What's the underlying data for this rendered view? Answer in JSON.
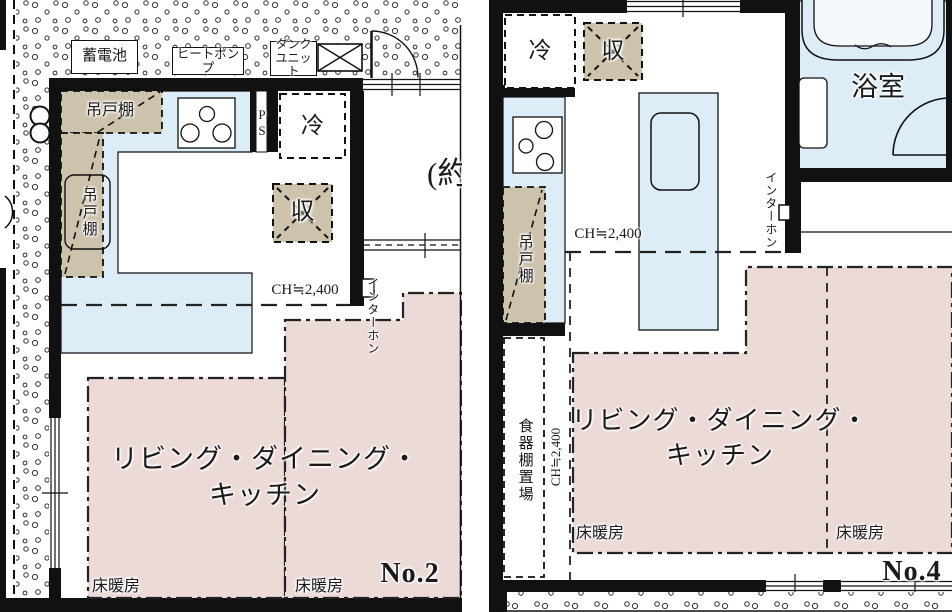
{
  "document": {
    "type": "floor-plan-pair",
    "description": "Two Japanese apartment floor plans shown side by side"
  },
  "colors": {
    "wall": "#111111",
    "floor_heating_pink": "#ecdad6",
    "cabinet_tan": "#cdc3ac",
    "counter_blue": "#dcedf8",
    "line": "#222222",
    "background": "#ffffff"
  },
  "icons": {
    "stove": "stove-burners-icon",
    "door": "door-swing-icon",
    "bathtub": "bathtub-icon",
    "sink": "sink-icon",
    "meter": "gas-meter-icon",
    "vent": "crossed-box-icon"
  },
  "no2": {
    "number": "No.2",
    "battery": "蓄電池",
    "heat_pump": "ヒートポンプ",
    "tank_unit_1": "タンク",
    "tank_unit_2": "ユニット",
    "cupboard_top": "吊戸棚",
    "cupboard_left": "吊戸棚",
    "ps": "PS",
    "fridge": "冷",
    "storage": "収",
    "ch": "CH≒2,400",
    "intercom": "インターホン",
    "approx": "(約",
    "ldk_1": "リビング・ダイニング・",
    "ldk_2": "キッチン",
    "floor_heating_1": "床暖房",
    "floor_heating_2": "床暖房"
  },
  "no4": {
    "number": "No.4",
    "fridge": "冷",
    "storage": "収",
    "bathroom": "浴室",
    "cupboard": "吊戸棚",
    "ch_main": "CH≒2,400",
    "ch_side": "CH≒2,400",
    "intercom": "インターホン",
    "dish_shelf": "食器棚置場",
    "ldk_1": "リビング・ダイニング・",
    "ldk_2": "キッチン",
    "floor_heating_1": "床暖房",
    "floor_heating_2": "床暖房"
  }
}
